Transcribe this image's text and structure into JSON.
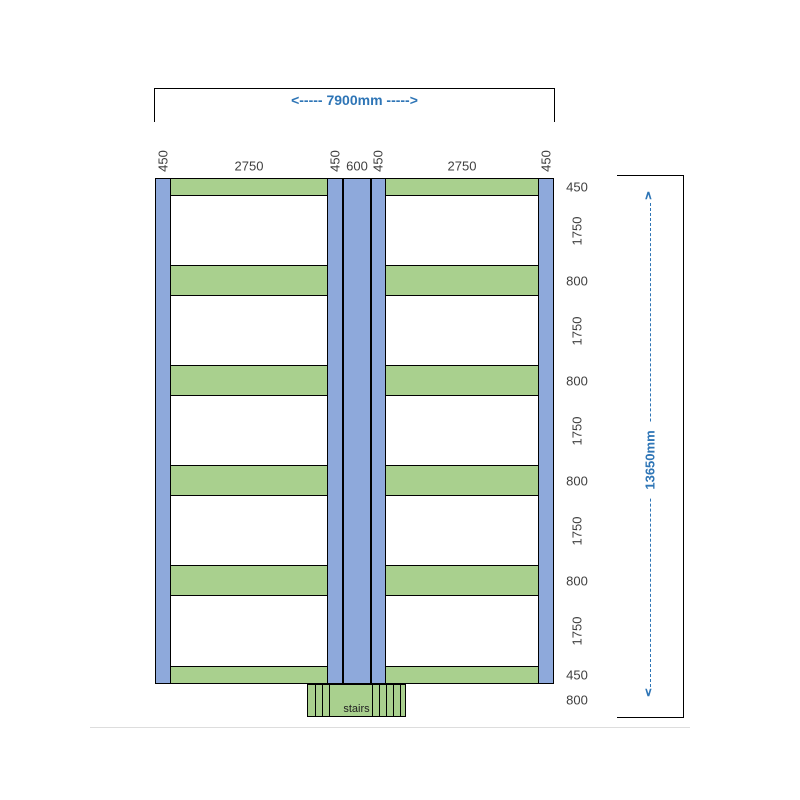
{
  "plan": {
    "top_dimension": "<----- 7900mm ----->",
    "height_dimension": "13650mm",
    "stairs_label": "stairs",
    "column_labels": [
      "450",
      "2750",
      "450",
      "600",
      "450",
      "2750",
      "450"
    ],
    "row_labels": [
      "450",
      "1750",
      "800",
      "1750",
      "800",
      "1750",
      "800",
      "1750",
      "800",
      "1750",
      "450",
      "800"
    ],
    "arrow_up_glyph": "∧",
    "arrow_down_glyph": "∨",
    "colors": {
      "column_fill": "#8EA9DB",
      "bar_fill": "#A9D08E",
      "outline": "#000000",
      "dimension_text": "#2E75B6",
      "label_text": "#3F3F3F"
    }
  }
}
